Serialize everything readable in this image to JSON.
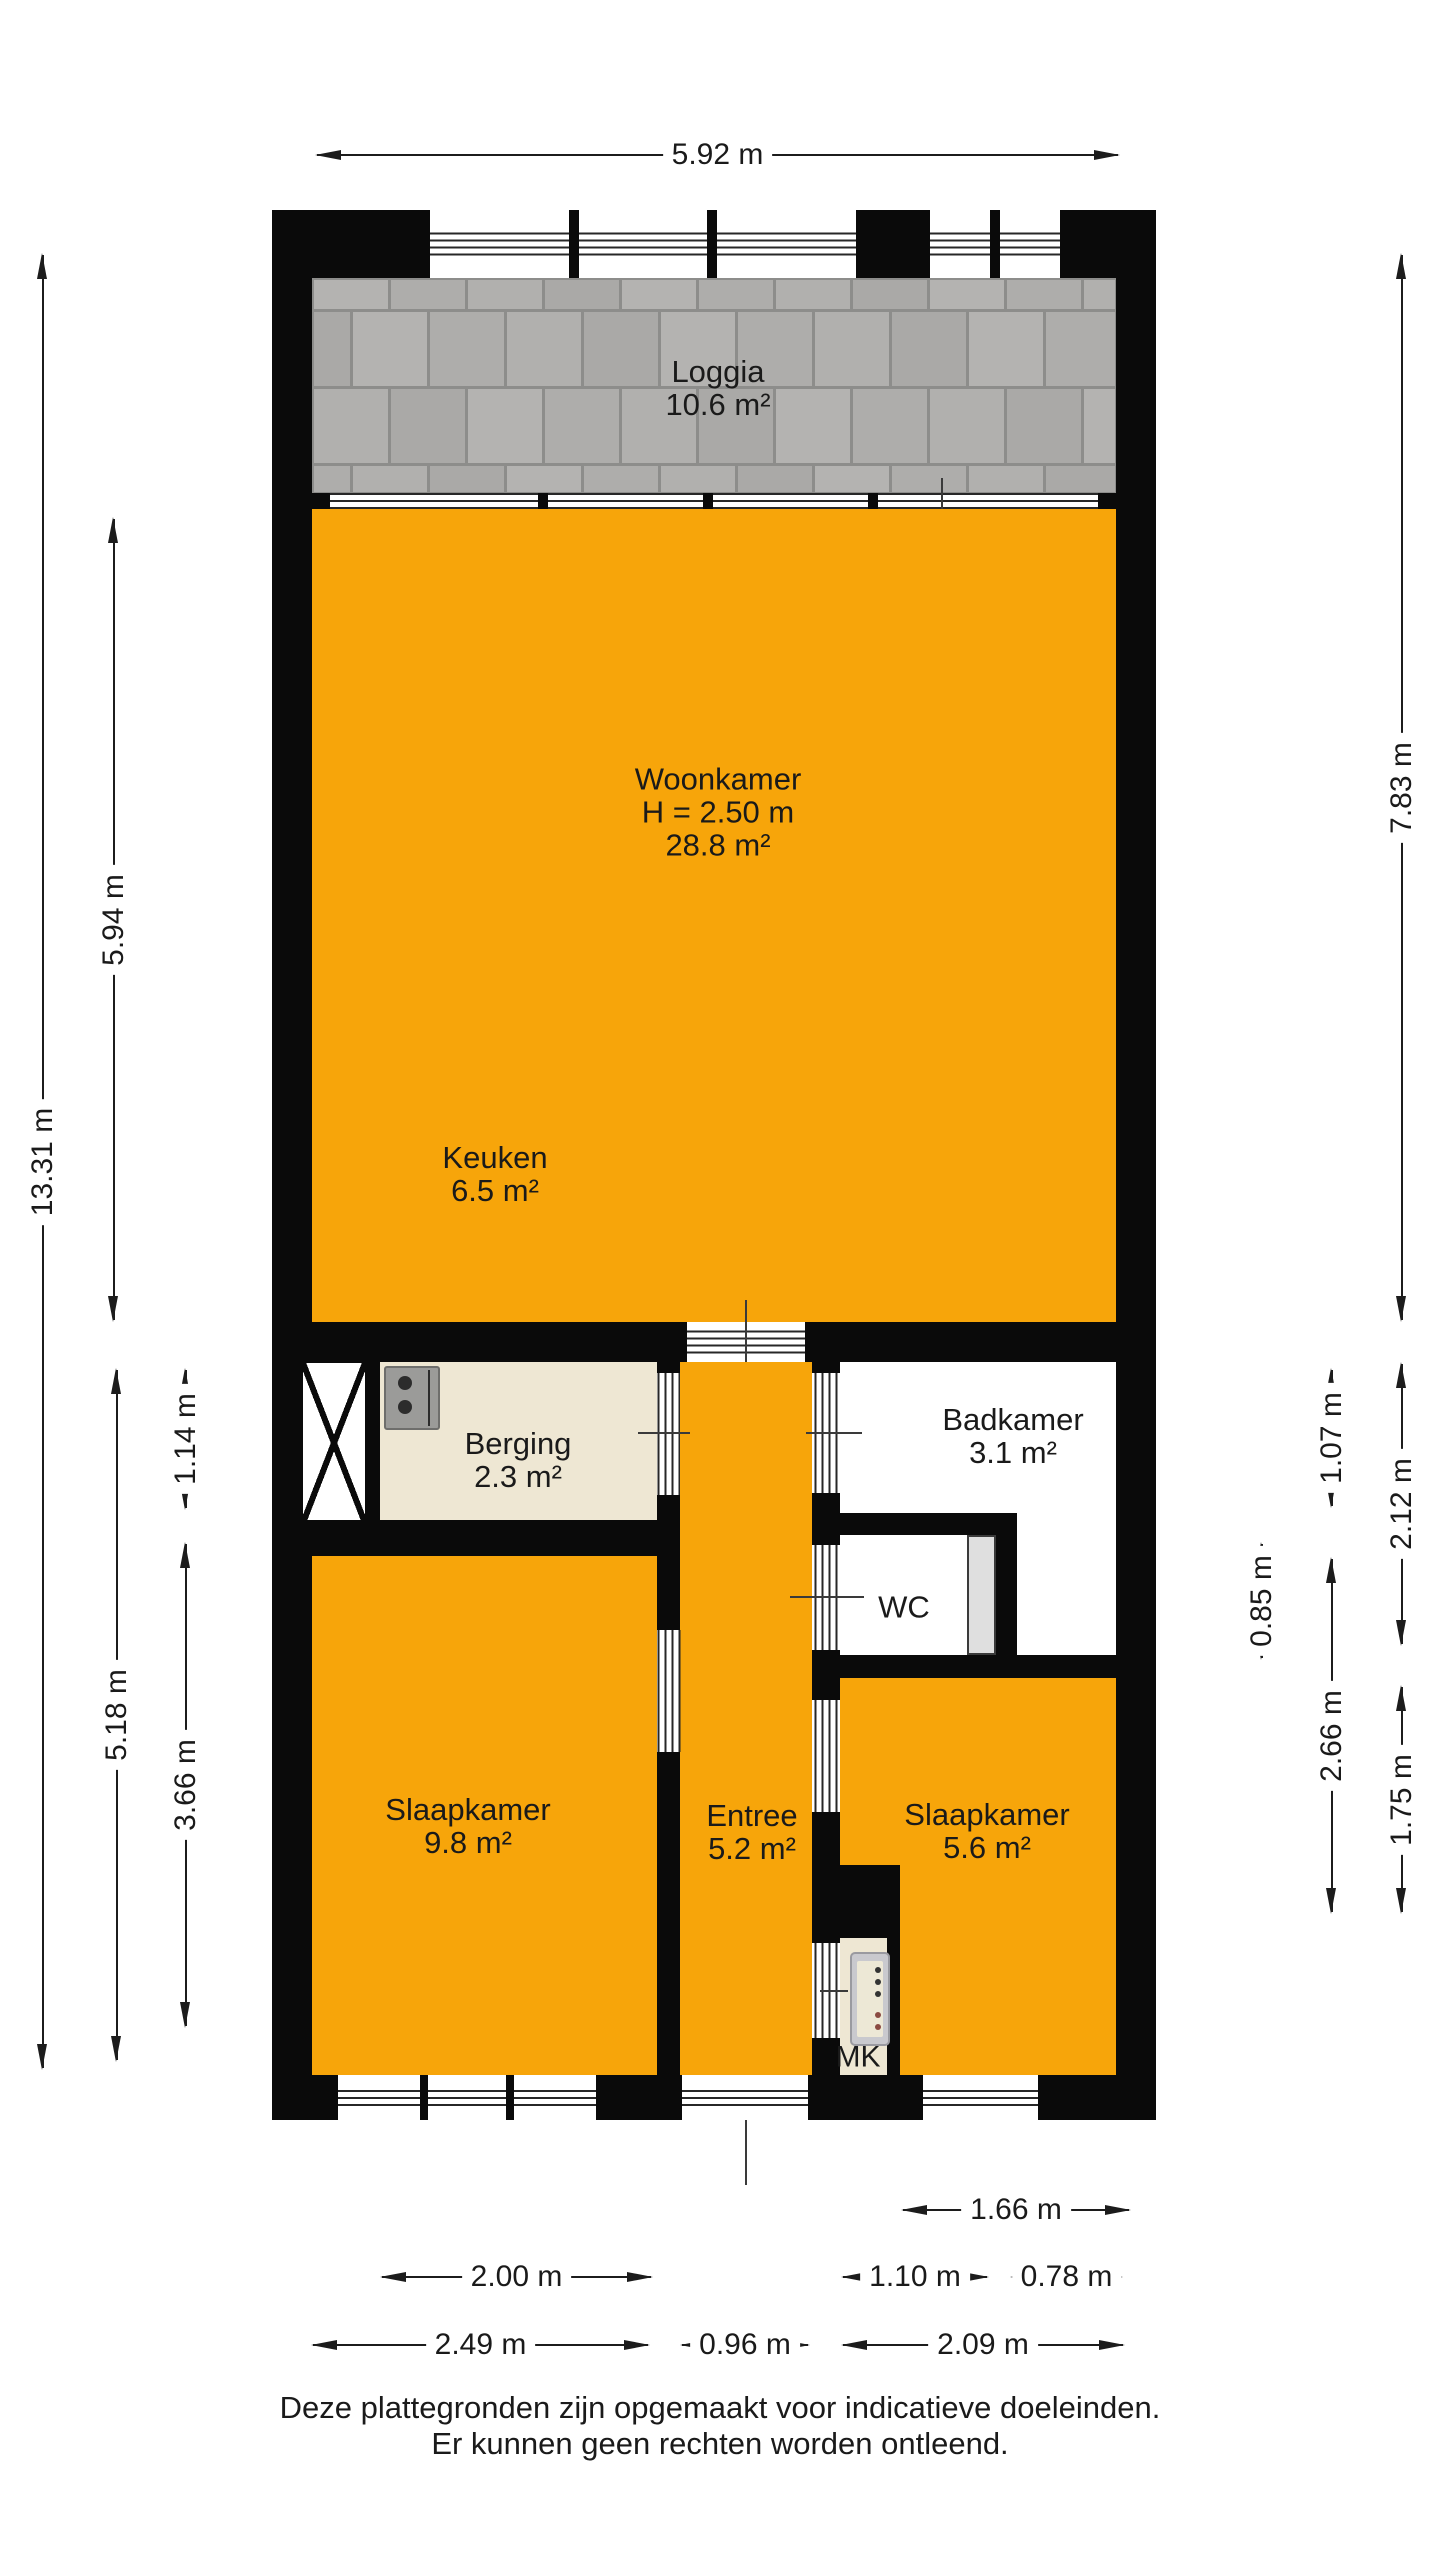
{
  "title": "Plattegrond appartement",
  "colors": {
    "orange": "#f7a50a",
    "beige": "#eee7d3",
    "wall": "#0a0a0a",
    "tile_grout": "#8d8d8b",
    "tile": "#b0afad"
  },
  "plan": {
    "rooms": {
      "loggia": {
        "name": "Loggia",
        "area": "10.6 m²"
      },
      "woonkamer": {
        "name": "Woonkamer",
        "height": "H = 2.50 m",
        "area": "28.8 m²"
      },
      "keuken": {
        "name": "Keuken",
        "area": "6.5 m²"
      },
      "berging": {
        "name": "Berging",
        "area": "2.3 m²"
      },
      "badkamer": {
        "name": "Badkamer",
        "area": "3.1 m²"
      },
      "wc": {
        "name": "WC"
      },
      "entree": {
        "name": "Entree",
        "area": "5.2 m²"
      },
      "slaapkamer_links": {
        "name": "Slaapkamer",
        "area": "9.8 m²"
      },
      "slaapkamer_rechts": {
        "name": "Slaapkamer",
        "area": "5.6 m²"
      },
      "meterkast": {
        "name": "MK"
      }
    }
  },
  "icons": {
    "berging_appliance": "boiler-icon",
    "meterkast_panel": "meter-panel-icon",
    "shaft": "shaft-cross-icon"
  },
  "dimensions": {
    "top": {
      "width": "5.92 m"
    },
    "left": {
      "total": "13.31 m",
      "woonkamer": "5.94 m",
      "berging": "1.14 m",
      "lower_section": "5.18 m",
      "slaapkamer": "3.66 m"
    },
    "right": {
      "upper_section": "7.83 m",
      "badkamer_inner": "1.07 m",
      "badkamer_zone": "2.12 m",
      "wc": "0.85 m",
      "lower_inner": "2.66 m",
      "slaapkamer": "1.75 m"
    },
    "bottom": {
      "mk_zone": "1.66 m",
      "window_left": "2.00 m",
      "window_right": "1.10 m",
      "right_corner": "0.78 m",
      "room_left": "2.49 m",
      "entree": "0.96 m",
      "room_right": "2.09 m"
    }
  },
  "footer": {
    "line1": "Deze plattegronden zijn opgemaakt voor indicatieve doeleinden.",
    "line2": "Er kunnen geen rechten worden ontleend."
  }
}
